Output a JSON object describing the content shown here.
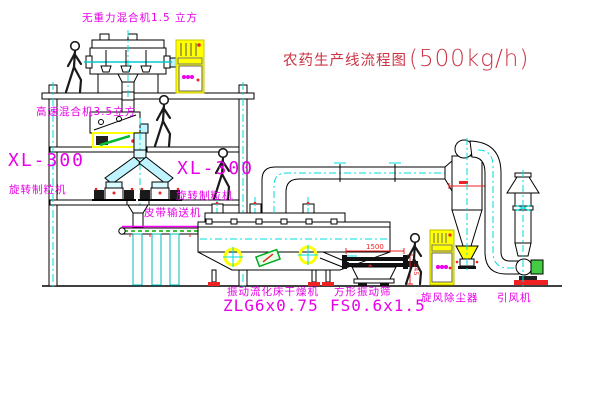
{
  "title": {
    "prefix": "农药生产线流程图",
    "capacity": "(500kg/h)"
  },
  "labels": {
    "top_mixer": "无重力混合机1.5 立方",
    "high_speed_mixer": "高速混合机3.5立方",
    "granulator_left_model": "XL-300",
    "granulator_left_name": "旋转制粒机",
    "granulator_mid_model": "XL-300",
    "granulator_mid_name": "旋转制粒机",
    "belt_conveyor": "皮带输送机",
    "dryer_name": "振动流化床干燥机",
    "dryer_model": "ZLG6x0.75",
    "sieve_name": "方形振动筛",
    "sieve_model": "FS0.6x1.5",
    "cyclone": "旋风除尘器",
    "fan": "引风机"
  },
  "dimensions": {
    "sieve_width": "1500",
    "sieve_height": "345"
  },
  "colors": {
    "label_magenta": "#e800e8",
    "title_red": "#cc3344",
    "line_black": "#000000",
    "centerline_cyan": "#00dddd",
    "highlight_yellow": "#ffff00",
    "accent_green": "#22bb22",
    "dimension_red": "#ee2222"
  }
}
